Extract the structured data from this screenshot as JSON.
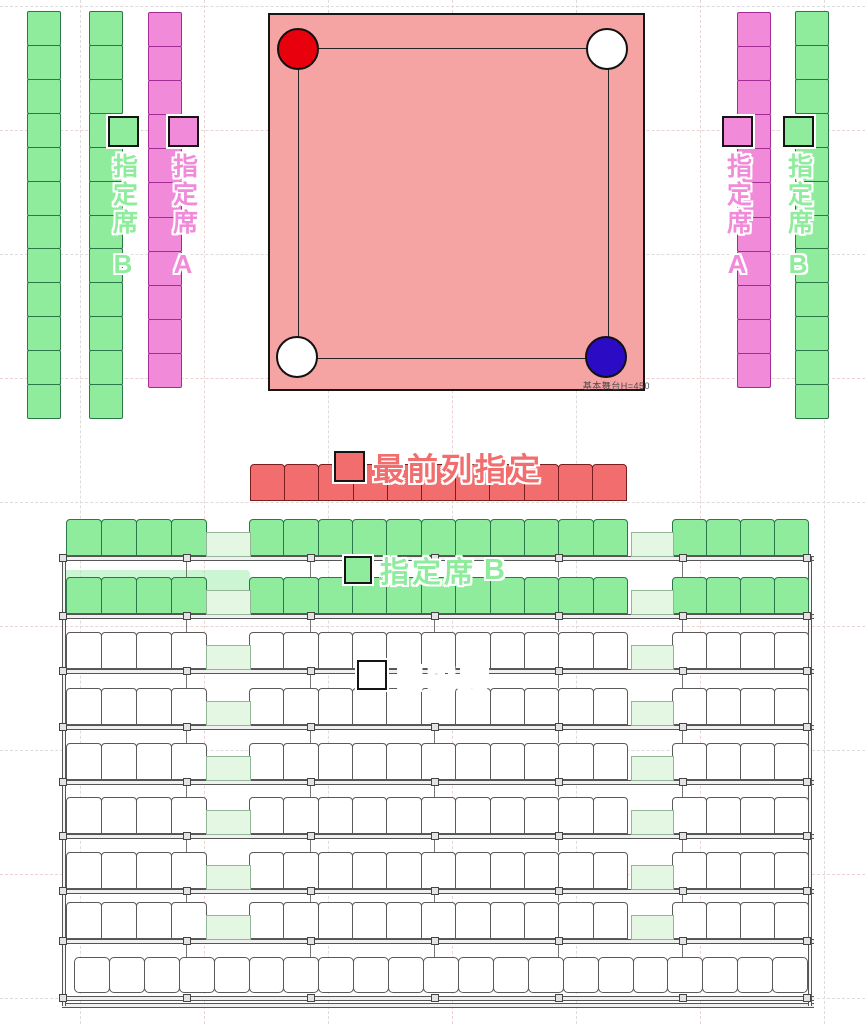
{
  "colors": {
    "green": "#8fec9d",
    "pink": "#f18ad9",
    "red": "#f26e6e",
    "aisle_green": "#e4f7e2",
    "ring_fill": "#f5a3a3",
    "corner_red": "#e8000d",
    "corner_white": "#ffffff",
    "corner_blue": "#2b0bc4"
  },
  "ring": {
    "note": "基本舞台H=450",
    "corners": [
      "red",
      "white",
      "white",
      "blue"
    ]
  },
  "side_columns": [
    {
      "id": "left-outer-green",
      "color": "green",
      "seats": 12
    },
    {
      "id": "left-b",
      "color": "green",
      "seats": 12,
      "label": {
        "seat_type": "指定席",
        "letter": "B"
      }
    },
    {
      "id": "left-a",
      "color": "pink",
      "seats": 11,
      "label": {
        "seat_type": "指定席",
        "letter": "A"
      }
    },
    {
      "id": "right-a",
      "color": "pink",
      "seats": 11,
      "label": {
        "seat_type": "指定席",
        "letter": "A"
      }
    },
    {
      "id": "right-b",
      "color": "green",
      "seats": 12,
      "label": {
        "seat_type": "指定席",
        "letter": "B"
      }
    }
  ],
  "front_row": {
    "label": "最前列指定",
    "seats": 11
  },
  "lower_block": {
    "reserved_label": {
      "seat_type": "指定席",
      "letter": "B"
    },
    "free_label": "自由席",
    "green_row_count": 2,
    "white_row_count": 6,
    "groups": [
      4,
      11,
      4
    ],
    "bottom_row_seats": 21
  }
}
